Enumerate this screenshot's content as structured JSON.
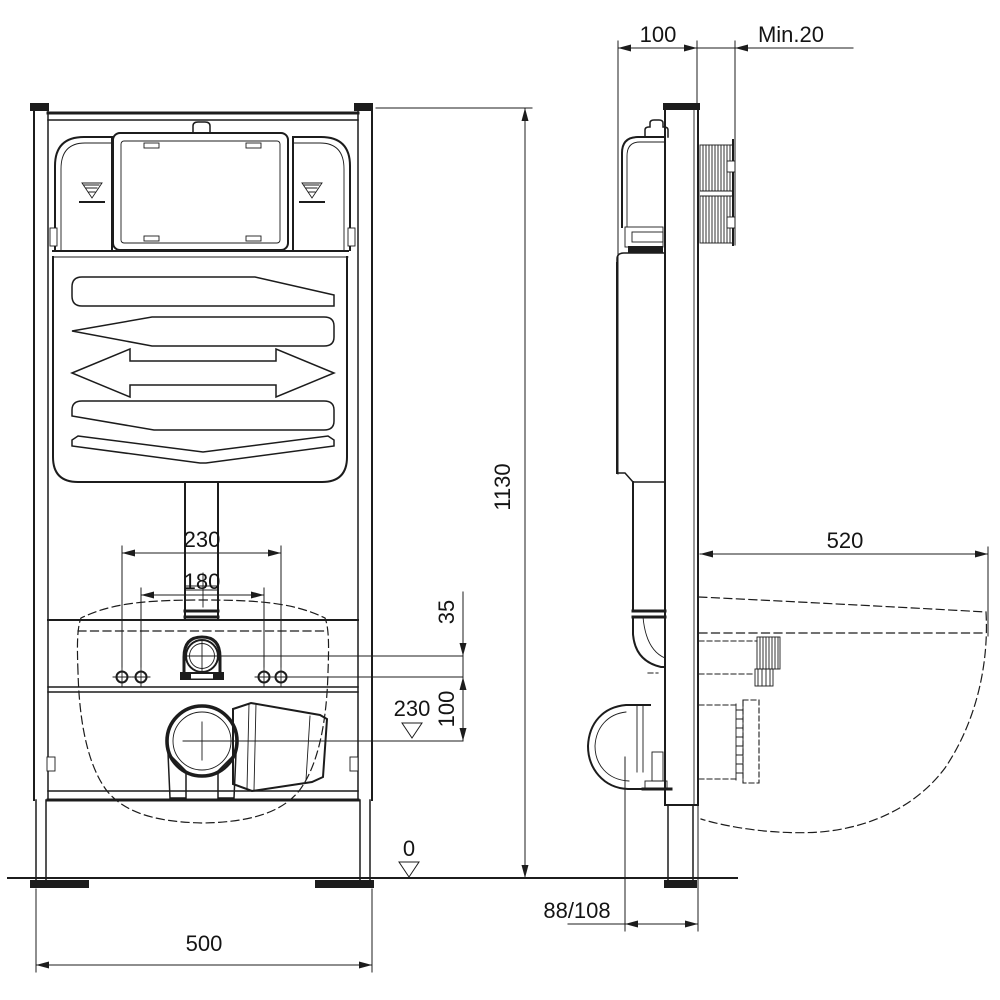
{
  "drawing": {
    "subject": "wall-hung-wc-concealed-cistern-frame-installation-diagram",
    "views": {
      "front": "front-view",
      "side": "side-view"
    },
    "line_color": "#1c1c1c",
    "background_color": "#ffffff"
  },
  "dimensions": {
    "frame_depth": "100",
    "min_wall_thickness": "Min.20",
    "frame_height": "1130",
    "bolt_spacing_outer": "230",
    "bolt_spacing_inner": "180",
    "inlet_above_bolts": "35",
    "bolts_above_drain": "100",
    "drain_center_height": "230",
    "floor_level": "0",
    "frame_width": "500",
    "bowl_projection": "520",
    "drain_wall_offset": "88/108"
  }
}
